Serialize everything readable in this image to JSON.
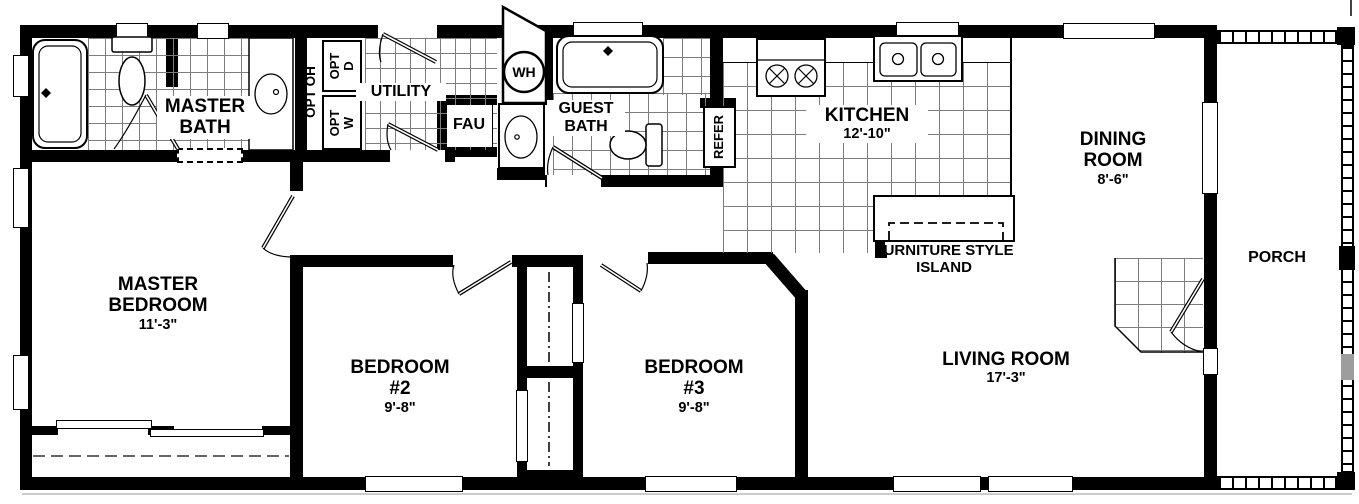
{
  "rooms": {
    "master_bath": {
      "name": "MASTER BATH"
    },
    "utility": {
      "name": "UTILITY"
    },
    "guest_bath": {
      "name": "GUEST BATH"
    },
    "kitchen": {
      "name": "KITCHEN",
      "dim": "12'-10\""
    },
    "dining_room": {
      "name": "DINING ROOM",
      "dim": "8'-6\""
    },
    "living_room": {
      "name": "LIVING ROOM",
      "dim": "17'-3\""
    },
    "master_bedroom": {
      "name": "MASTER BEDROOM",
      "dim": "11'-3\""
    },
    "bedroom_2": {
      "name": "BEDROOM #2",
      "dim": "9'-8\""
    },
    "bedroom_3": {
      "name": "BEDROOM #3",
      "dim": "9'-8\""
    },
    "porch": {
      "name": "PORCH"
    }
  },
  "fixtures": {
    "water_heater": "WH",
    "fau": "FAU",
    "refrigerator": "REFER",
    "opt_overhead": "OPT OH",
    "opt_dryer": {
      "line1": "OPT",
      "line2": "D"
    },
    "opt_washer": {
      "line1": "OPT",
      "line2": "W"
    },
    "island": {
      "line1": "FURNITURE STYLE",
      "line2": "ISLAND"
    }
  },
  "colors": {
    "wall": "#000000",
    "tile_line": "#7d7d7d",
    "porch_step": "#9d9d9d"
  }
}
